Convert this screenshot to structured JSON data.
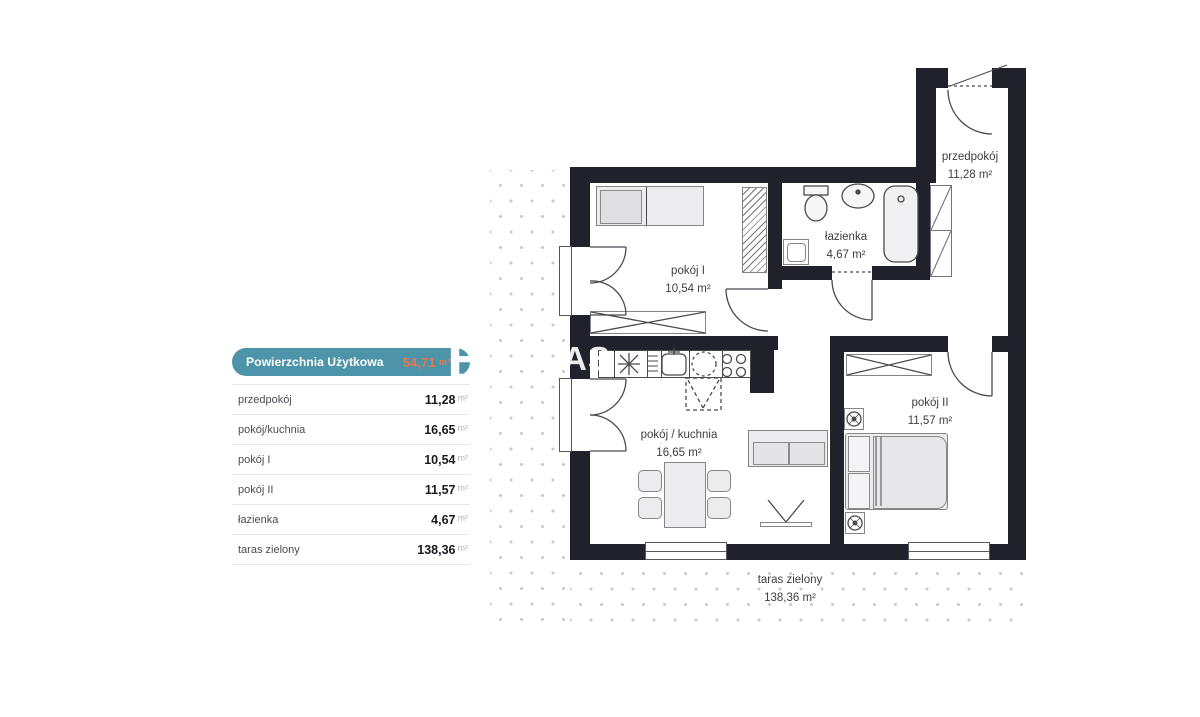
{
  "panel": {
    "header": {
      "label": "Powierzchnia Użytkowa",
      "value": "54,71",
      "unit": "m²"
    },
    "rows": [
      {
        "label": "przedpokój",
        "value": "11,28",
        "unit": "m²"
      },
      {
        "label": "pokój/kuchnia",
        "value": "16,65",
        "unit": "m²"
      },
      {
        "label": "pokój I",
        "value": "10,54",
        "unit": "m²"
      },
      {
        "label": "pokój II",
        "value": "11,57",
        "unit": "m²"
      },
      {
        "label": "łazienka",
        "value": "4,67",
        "unit": "m²"
      },
      {
        "label": "taras zielony",
        "value": "138,36",
        "unit": "m²"
      }
    ]
  },
  "plan": {
    "labels": {
      "przedpokoj": {
        "name": "przedpokój",
        "area": "11,28 m²"
      },
      "lazienka": {
        "name": "łazienka",
        "area": "4,67 m²"
      },
      "pokoj1": {
        "name": "pokój I",
        "area": "10,54 m²"
      },
      "pokoj2": {
        "name": "pokój II",
        "area": "11,57 m²"
      },
      "pokoj_kuchnia": {
        "name": "pokój / kuchnia",
        "area": "16,65 m²"
      },
      "taras": {
        "name": "taras zielony",
        "area": "138,36 m²"
      }
    }
  },
  "watermark": {
    "letter": "B",
    "fragment": "AS"
  },
  "colors": {
    "teal": "#4d94a9",
    "orange": "#e8764f",
    "wall": "#21212b",
    "dots": "#c9c9ce"
  }
}
